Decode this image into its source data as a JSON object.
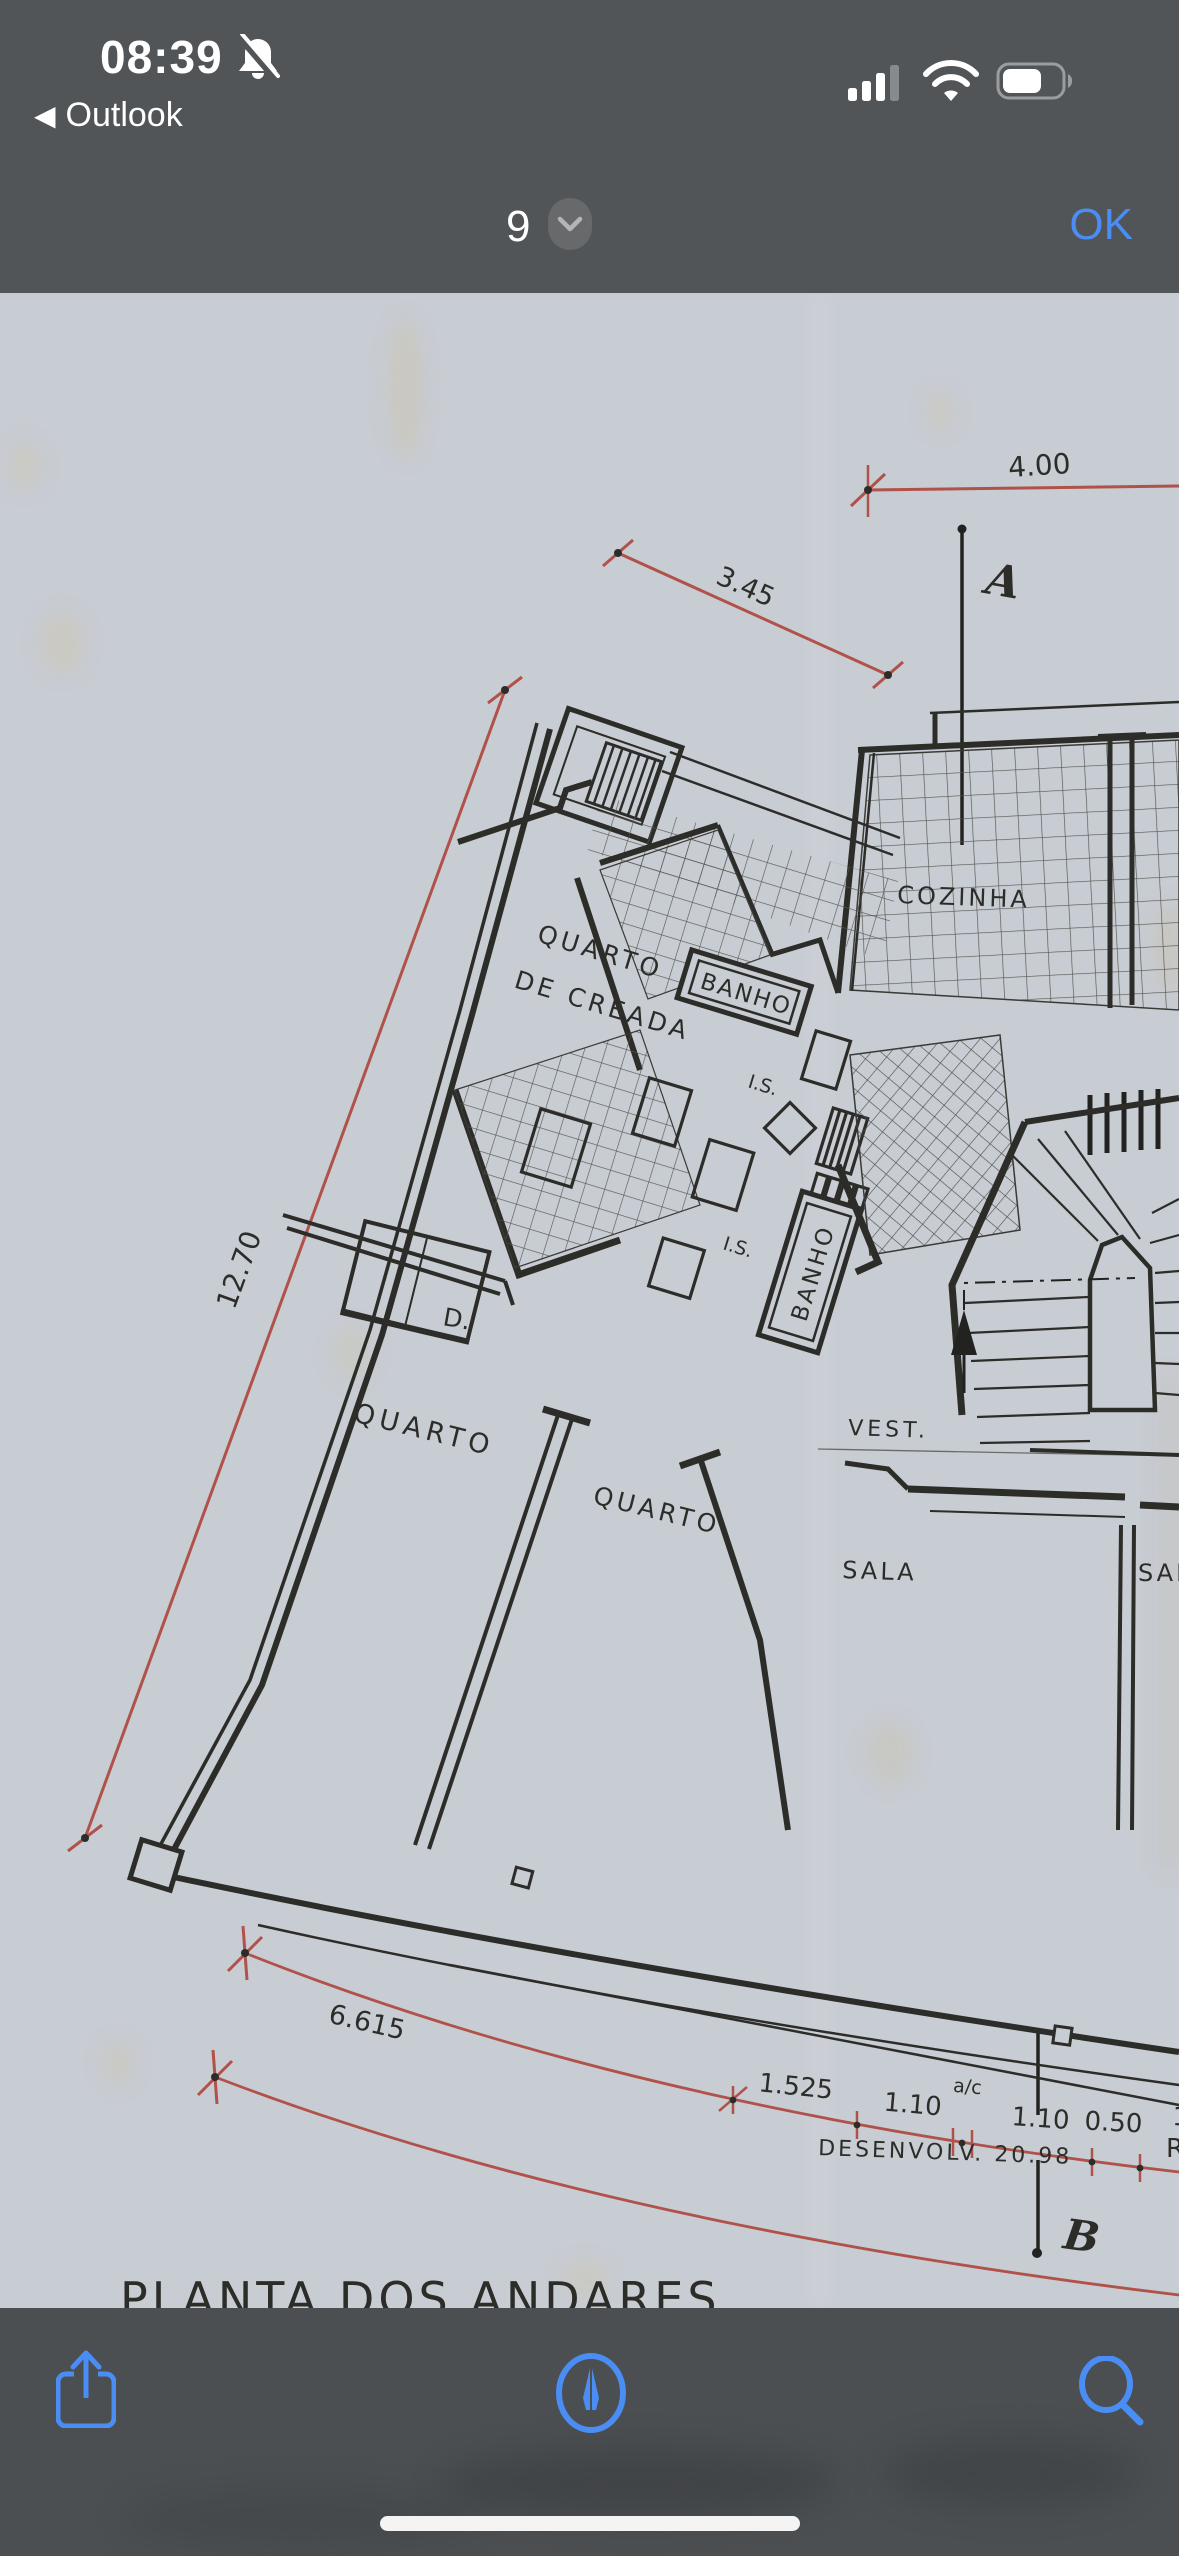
{
  "status_bar": {
    "time": "08:39",
    "back_arrow": "◀",
    "back_app": "Outlook",
    "signal_level": "3 of 4 bars",
    "battery_level": "60%"
  },
  "nav_bar": {
    "page_number": "9",
    "ok_label": "OK"
  },
  "plan": {
    "title": "PLANTA  DOS  ANDARES",
    "rooms": {
      "maid_room_line1": "QUARTO",
      "maid_room_line2": "DE CREADA",
      "banho1": "BANHO",
      "banho2": "BANHO",
      "is1": "I.S.",
      "is2": "I.S.",
      "cozinha": "COZINHA",
      "closet": "D.",
      "quarto1": "QUARTO",
      "quarto2": "QUARTO",
      "vest": "VEST.",
      "sala": "SALA",
      "sala_partial": "SALA"
    },
    "sections": {
      "a": "A",
      "b": "B"
    },
    "dims": {
      "d400": "4.00",
      "d345": "3.45",
      "d1270": "12.70",
      "d6615": "6.615",
      "d1525": "1.525",
      "d110a": "1.10",
      "dac": "a/c",
      "d110b": "1.10",
      "d050": "0.50",
      "d1partial": "1.",
      "desenvolv": "DESENVOLV.  20.98",
      "r_partial": "R"
    }
  },
  "colors": {
    "chrome_gray": "#515558",
    "ios_blue": "#4a8df5",
    "dimension_red": "#b0524a",
    "ink": "#2c2c28",
    "paper": "#c8ccd3"
  }
}
